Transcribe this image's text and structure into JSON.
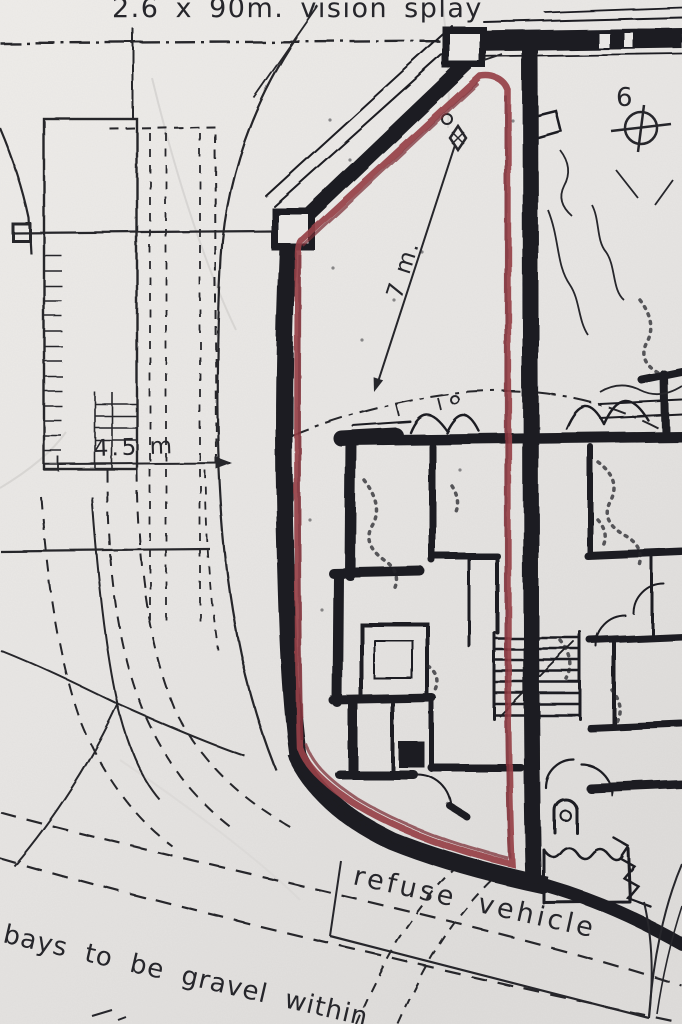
{
  "drawing": {
    "kind": "scanned site plan",
    "annotations": {
      "splay_note": "2.6 x 90m. vision splay",
      "plot_number": "6",
      "dim_7m": "7 m.",
      "dim_4_5m": "4.5 m",
      "refuse_label": "refuse vehicle",
      "bays_note": "bays to be gravel within"
    },
    "colors": {
      "paper": "#e9e7e5",
      "ink": "#26262b",
      "wall_black": "#1c1c21",
      "boundary_red": "#963f47"
    },
    "symbols": {
      "plot_marker": "crosshair-circle",
      "survey_point": "diamond-with-circle"
    }
  }
}
